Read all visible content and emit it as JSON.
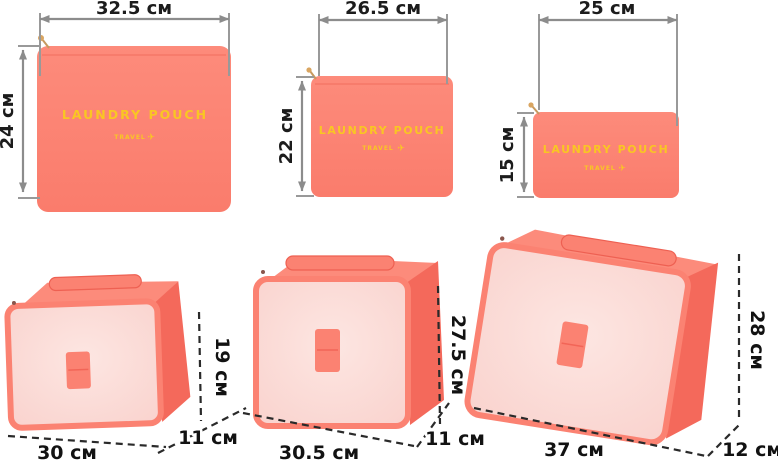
{
  "figure": "travel-packing-set-dimensions",
  "colors": {
    "coral": "#FB8272",
    "coral_dark": "#F4695B",
    "coral_trim": "#EE6052",
    "panel_pink": "#FBDAD6",
    "brand_yellow": "#F9C623",
    "dim_gray": "#8C8C8C",
    "dim_black": "#2A2A2A",
    "zipper_gold": "#D9A561"
  },
  "pouches": [
    {
      "title": "LAUNDRY POUCH",
      "subtitle": "TRAVEL",
      "plane_icon": "✈",
      "width_label": "32.5 см",
      "height_label": "24 см"
    },
    {
      "title": "LAUNDRY POUCH",
      "subtitle": "TRAVEL",
      "plane_icon": "✈",
      "width_label": "26.5 см",
      "height_label": "22 см"
    },
    {
      "title": "LAUNDRY POUCH",
      "subtitle": "TRAVEL",
      "plane_icon": "✈",
      "width_label": "25 см",
      "height_label": "15 см"
    }
  ],
  "cubes": [
    {
      "width_label": "30 см",
      "height_label": "19 см",
      "depth_label": "11 см"
    },
    {
      "width_label": "30.5 см",
      "height_label": "27.5 см",
      "depth_label": "11 см"
    },
    {
      "width_label": "37 см",
      "height_label": "28 см",
      "depth_label": "12 см"
    }
  ]
}
